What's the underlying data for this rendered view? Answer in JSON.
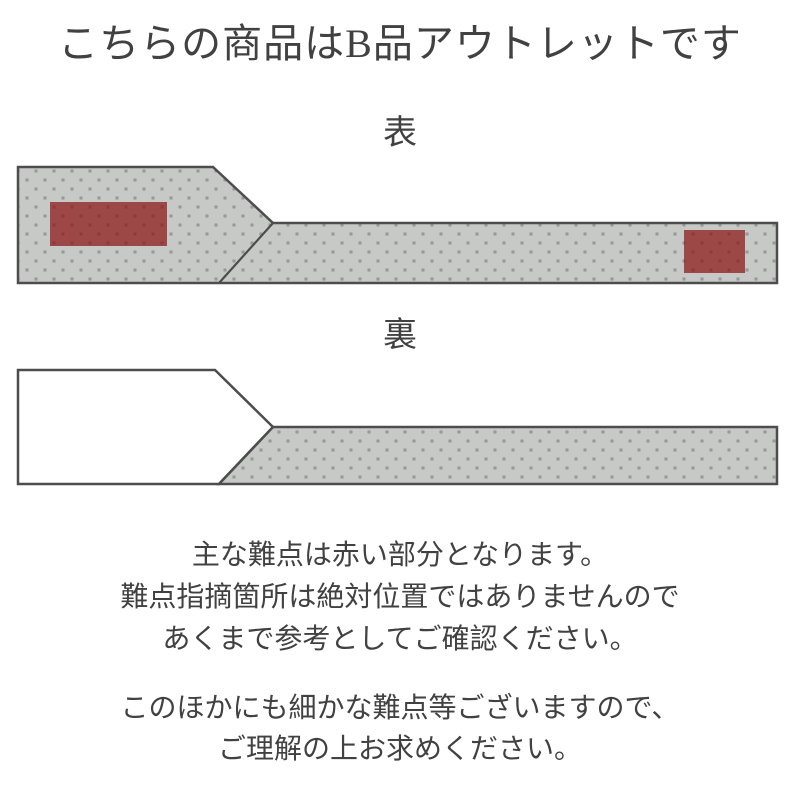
{
  "title": "こちらの商品はB品アウトレットです",
  "front": {
    "label": "表",
    "defects": [
      {
        "x": 50,
        "y": 202,
        "w": 117,
        "h": 44
      },
      {
        "x": 684,
        "y": 230,
        "w": 61,
        "h": 43
      }
    ]
  },
  "back": {
    "label": "裏"
  },
  "notes": {
    "line1": "主な難点は赤い部分となります。",
    "line2": "難点指摘箇所は絶対位置ではありませんので",
    "line3": "あくまで参考としてご確認ください。",
    "line4": "このほかにも細かな難点等ございますので、",
    "line5": "ご理解の上お求めください。"
  },
  "colors": {
    "text": "#414141",
    "outline": "#4d4d4d",
    "pattern-bg": "#9a9a9a",
    "pattern-light": "#c7c9c7",
    "defect-red": "#8b1616",
    "fabric-white": "#ffffff"
  }
}
